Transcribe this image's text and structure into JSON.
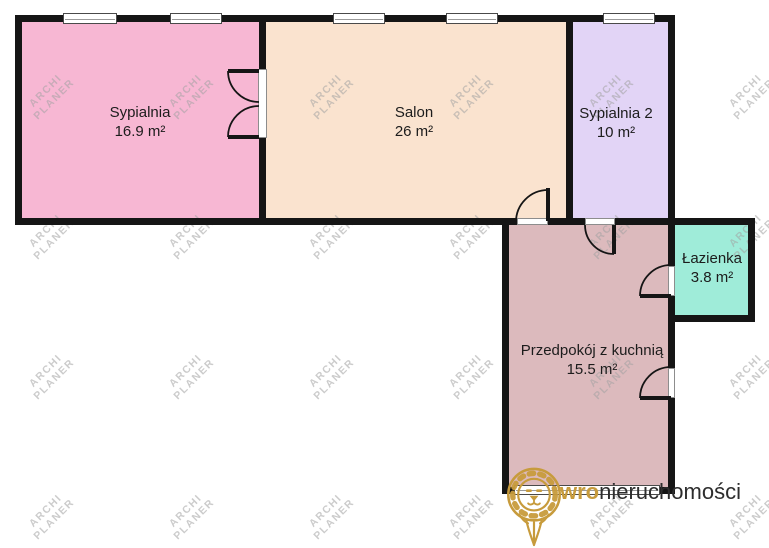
{
  "plan": {
    "rooms": [
      {
        "id": "sypialnia",
        "name": "Sypialnia",
        "area": "16.9 m²",
        "color": "#f7b7d3"
      },
      {
        "id": "salon",
        "name": "Salon",
        "area": "26 m²",
        "color": "#fae3cf"
      },
      {
        "id": "sypialnia2",
        "name": "Sypialnia 2",
        "area": "10 m²",
        "color": "#e2d4f6"
      },
      {
        "id": "lazienka",
        "name": "Łazienka",
        "area": "3.8 m²",
        "color": "#9fecd9"
      },
      {
        "id": "przedpokoj",
        "name": "Przedpokój z kuchnią",
        "area": "15.5 m²",
        "color": "#dcbabd"
      }
    ],
    "wall_color": "#151515"
  },
  "watermark": {
    "line1": "ARCHI",
    "line2": "PLANER"
  },
  "branding": {
    "logo_accent": "wro",
    "logo_main": "nieruchomości",
    "accent_color": "#c79b3c",
    "text_color": "#2d2d2d",
    "lion_icon": "lion-icon"
  }
}
